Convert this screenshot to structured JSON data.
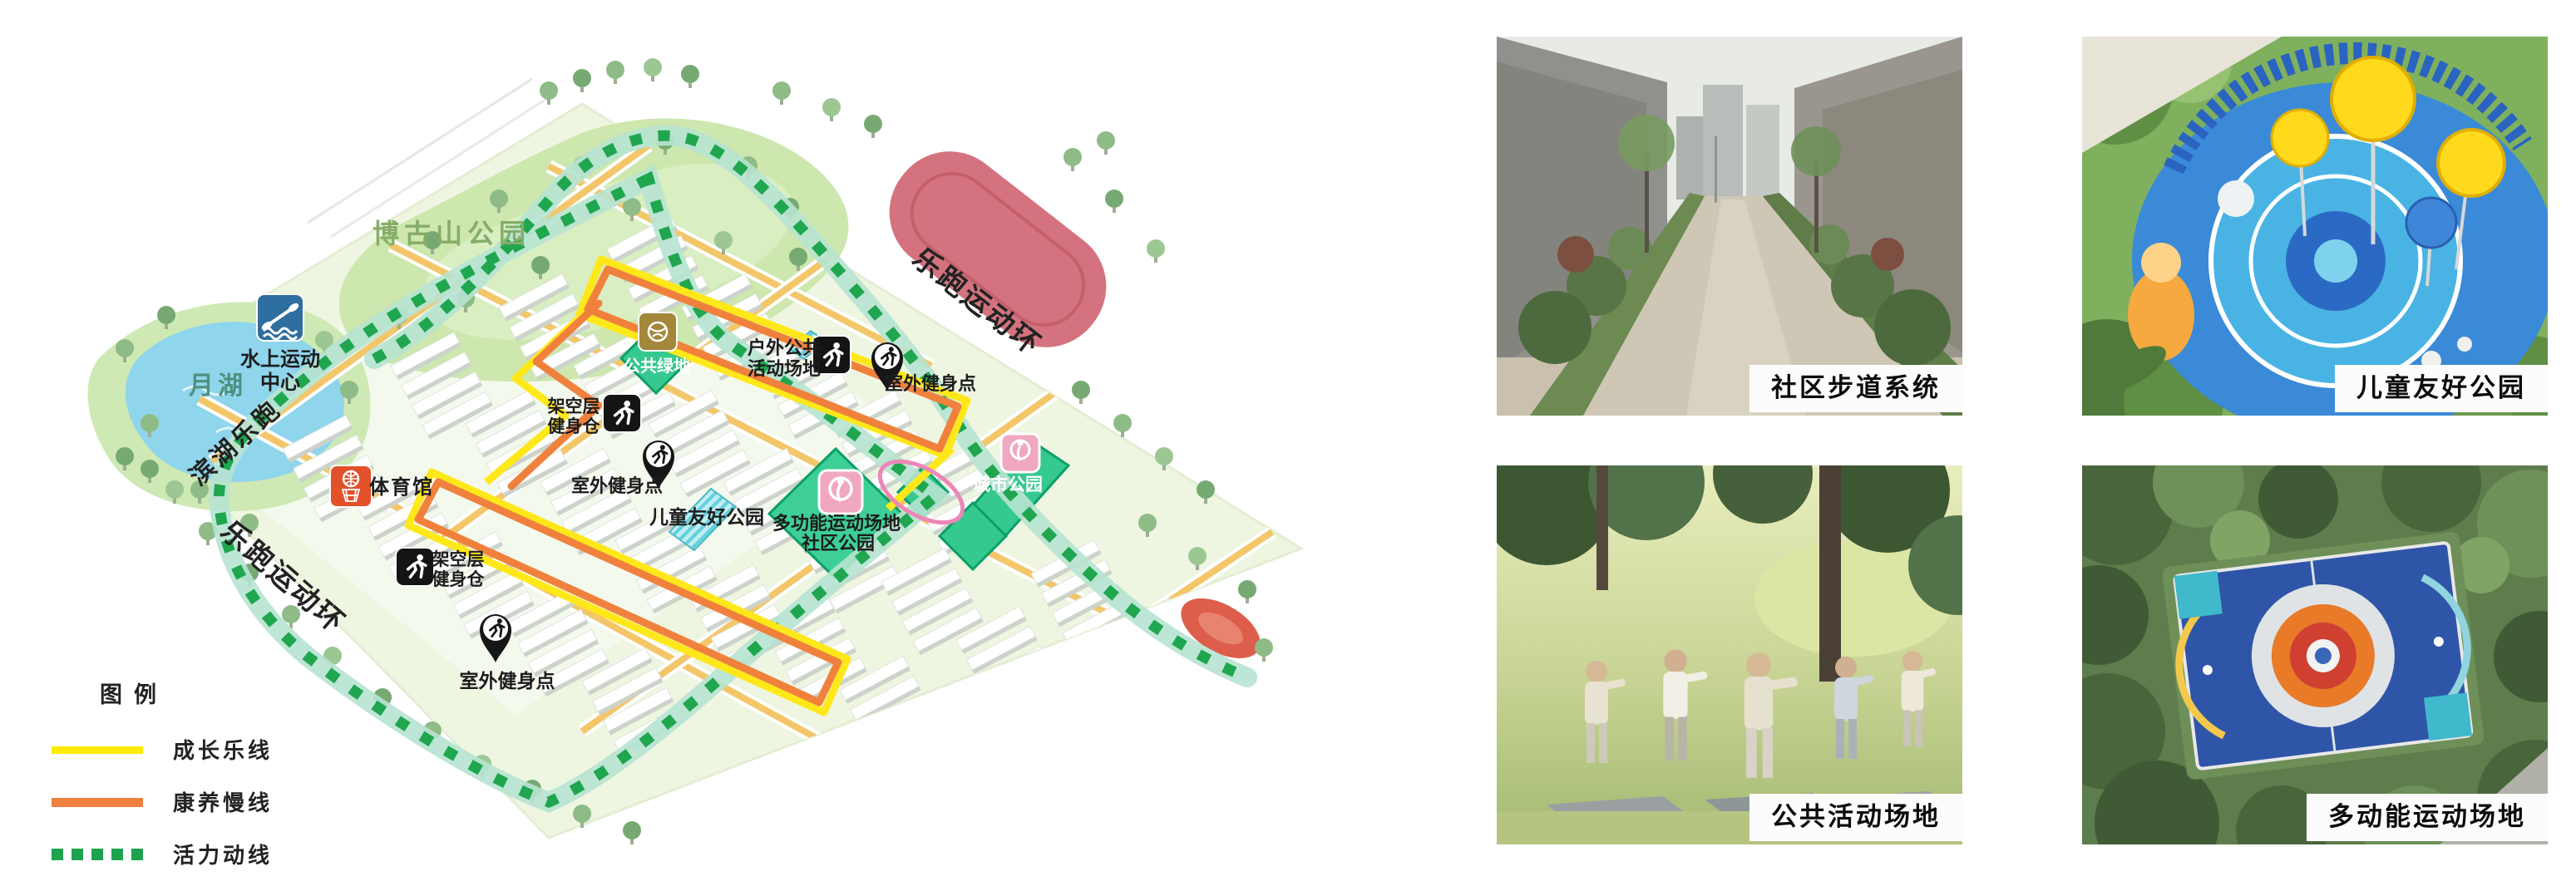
{
  "legend": {
    "title": "图例",
    "items": [
      {
        "label": "成长乐线",
        "color": "#ffec00",
        "style": "solid"
      },
      {
        "label": "康养慢线",
        "color": "#f08040",
        "style": "solid"
      },
      {
        "label": "活力动线",
        "color": "#1ea24d",
        "style": "dashed"
      }
    ]
  },
  "map": {
    "parks": {
      "bogu": "博古山公园",
      "moon_lake": "月湖",
      "children": "儿童友好公园",
      "city": "城市公园",
      "community_line1": "多功能运动场地",
      "community_line2": "社区公园",
      "public_green": "公共绿地"
    },
    "facilities": {
      "water_line1": "水上运动",
      "water_line2": "中心",
      "gym": "体育馆",
      "stilt_line1": "架空层",
      "stilt_line2": "健身仓",
      "outdoor_line1": "户外公共",
      "outdoor_line2": "活动场地",
      "fitness_point": "室外健身点"
    },
    "routes": {
      "lakeside": "滨湖乐跑",
      "ring": "乐跑运动环"
    }
  },
  "photos": [
    {
      "caption": "社区步道系统"
    },
    {
      "caption": "儿童友好公园"
    },
    {
      "caption": "公共活动场地"
    },
    {
      "caption": "多动能运动场地"
    }
  ]
}
